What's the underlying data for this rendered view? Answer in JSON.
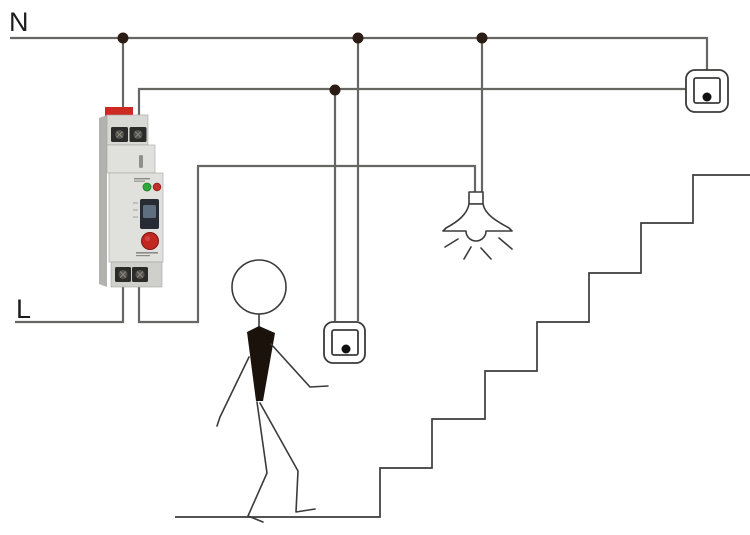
{
  "diagram": {
    "title": "staircase-lighting-timer-wiring-diagram",
    "labels": {
      "neutral": "N",
      "line": "L"
    },
    "colors": {
      "wire": "#666663",
      "outline": "#3b3b3b",
      "junction_dot": "#2b1d15",
      "switch_dot": "#111111",
      "label_text": "#1d1d1d",
      "device_clip_red": "#cd2a24",
      "device_body": "#d8d8d4",
      "device_body_light": "#e0e0dc",
      "device_body_dark": "#cfcfcb",
      "device_side": "#b2b2ae",
      "terminal_dark": "#2b2b29",
      "screw_metal": "#55534e",
      "led_green": "#2ea83c",
      "led_red": "#c03028",
      "knob_red": "#c22822",
      "slider_dark": "#272b33",
      "slider_knob": "#5f6f80",
      "figure_body": "#1c120c"
    }
  }
}
